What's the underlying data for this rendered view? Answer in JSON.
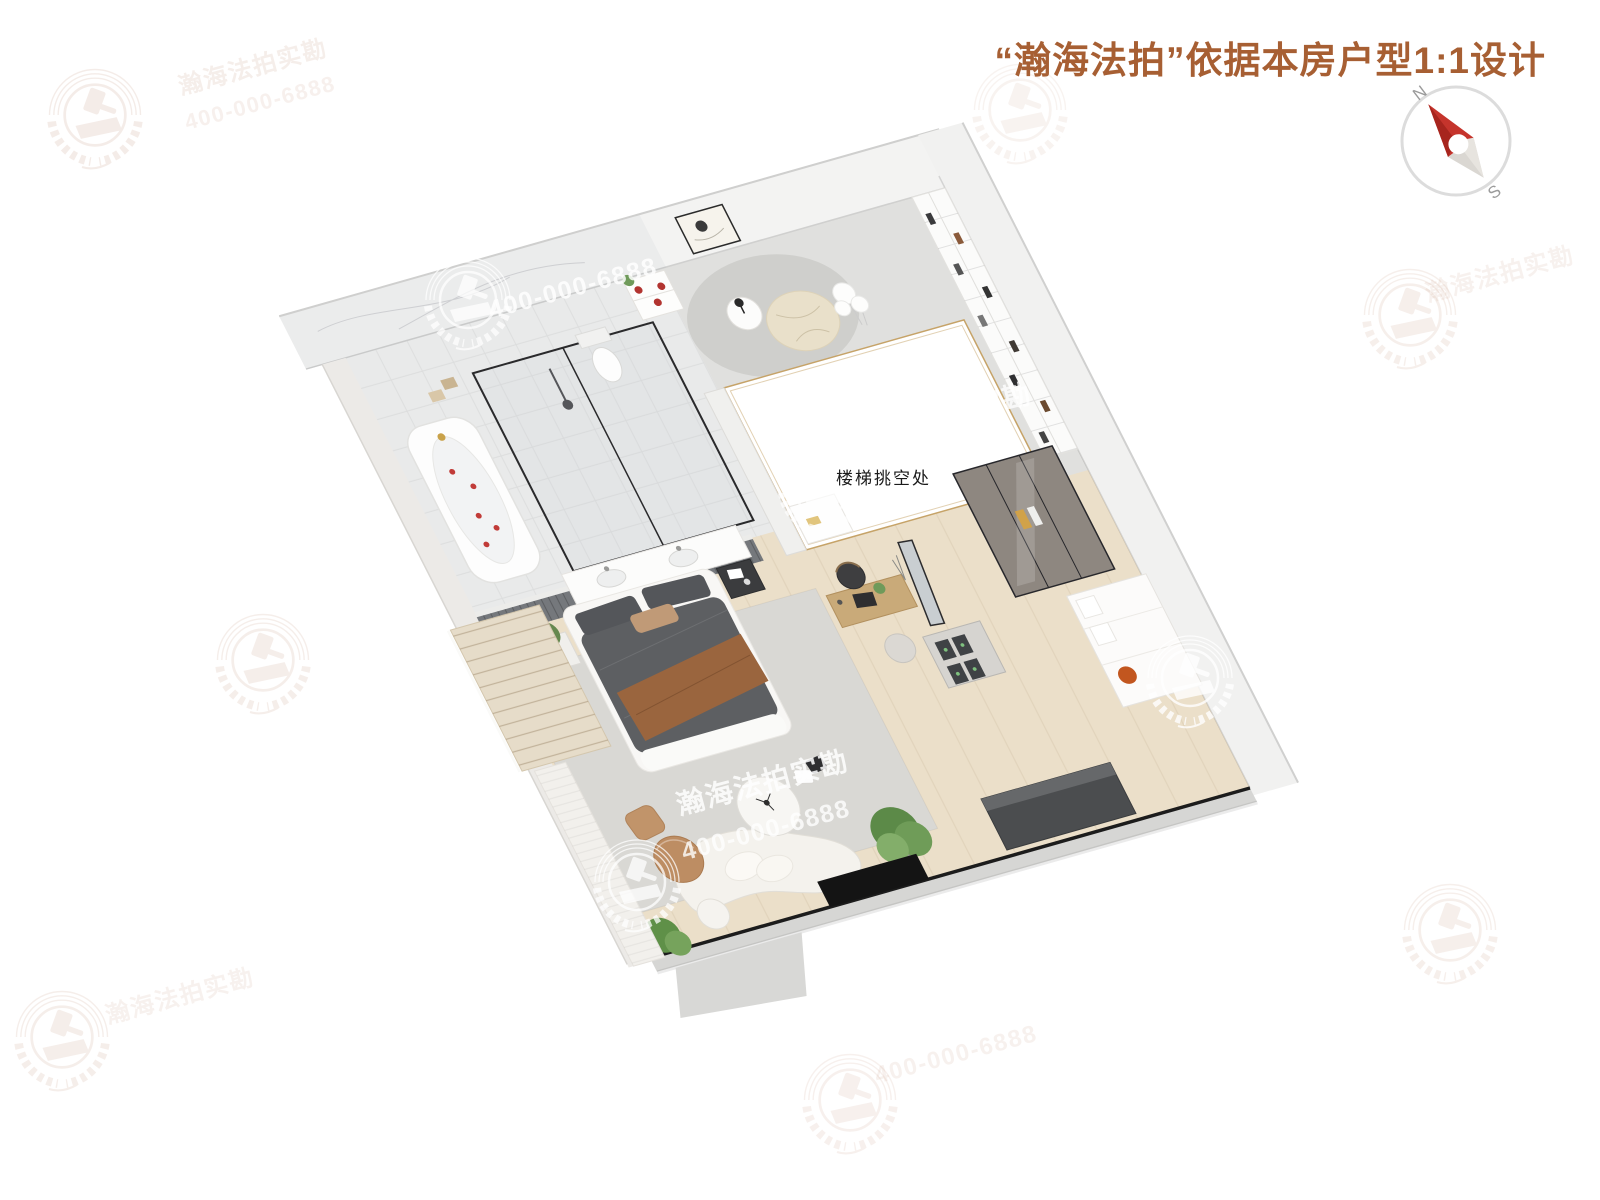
{
  "header": {
    "title": "“瀚海法拍”依据本房户型1:1设计"
  },
  "compass": {
    "north": "N",
    "south": "S"
  },
  "plan": {
    "void_label": "楼梯挑空处"
  },
  "watermark": {
    "brand_full": "瀚海法拍实勘",
    "brand_partial": "海法拍实勘",
    "phone": "400-000-6888",
    "badge_icon": "laurel-gavel-badge"
  },
  "colors": {
    "title": "#a75f33",
    "needle_red": "#c5342c",
    "needle_gray": "#dad7d2",
    "compass_ring": "#dcdcdc",
    "wood_floor": "#ebdfc9",
    "bathroom_tile": "#e9eaea",
    "stone_floor": "#e0e0de",
    "rug_gray": "#d9d8d4",
    "window_frame_black": "#1c1c1c",
    "void_rail_gold": "#c6a368",
    "watermark_pink": "#b97f63"
  }
}
